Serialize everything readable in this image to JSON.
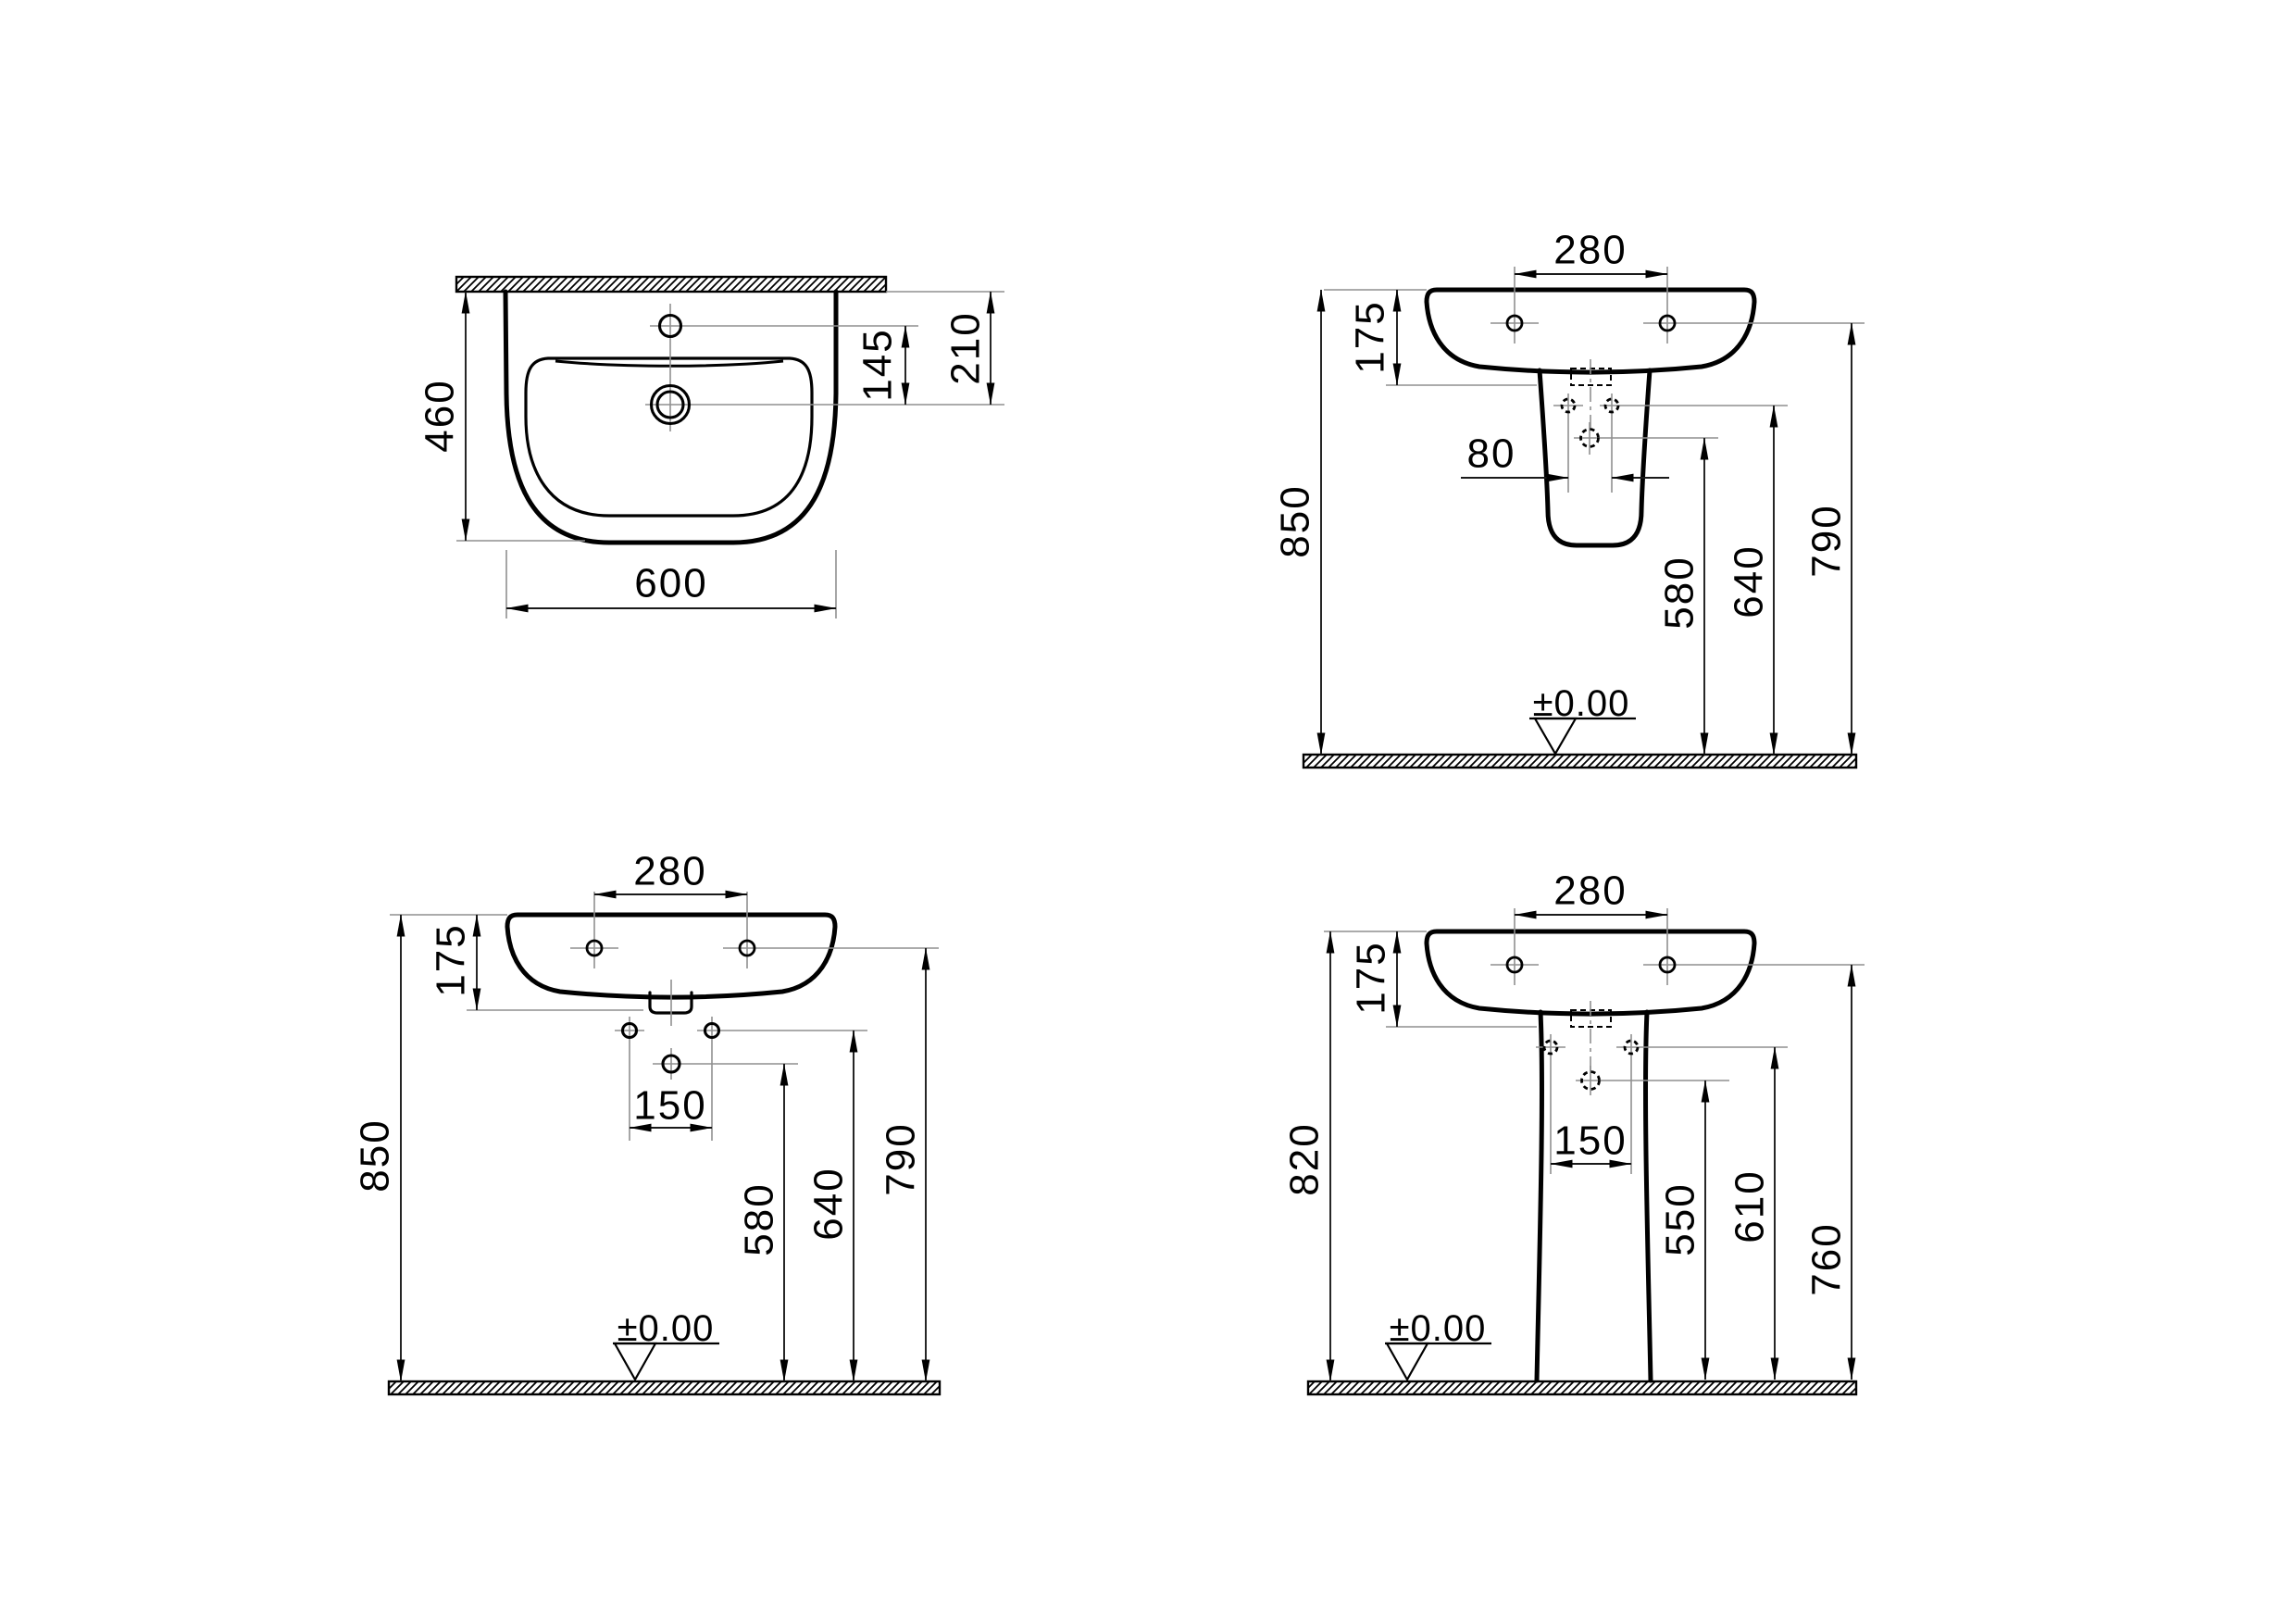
{
  "page": {
    "background": "#ffffff"
  },
  "colors": {
    "outline": "#000000",
    "dimension_text": "#000000",
    "reference_line": "#8f8f8f"
  },
  "views": {
    "plan": {
      "dim_width": "600",
      "dim_depth": "460",
      "dim_tap_to_drain": "145",
      "dim_wall_to_drain": "210"
    },
    "front_semi_pedestal": {
      "dim_tap_holes": "280",
      "dim_basin_depth": "175",
      "dim_fixing_holes": "80",
      "dim_rim_height": "850",
      "dim_drain_height": "580",
      "dim_fixing_height": "640",
      "dim_mounting_height": "790",
      "datum_level": "±0.00"
    },
    "front_wall_hung": {
      "dim_tap_holes": "280",
      "dim_basin_depth": "175",
      "dim_fixing_holes": "150",
      "dim_rim_height": "850",
      "dim_drain_height": "580",
      "dim_fixing_height": "640",
      "dim_mounting_height": "790",
      "datum_level": "±0.00"
    },
    "front_pedestal": {
      "dim_tap_holes": "280",
      "dim_basin_depth": "175",
      "dim_fixing_holes": "150",
      "dim_rim_height": "820",
      "dim_drain_height": "550",
      "dim_fixing_height": "610",
      "dim_mounting_height": "760",
      "datum_level": "±0.00"
    }
  }
}
